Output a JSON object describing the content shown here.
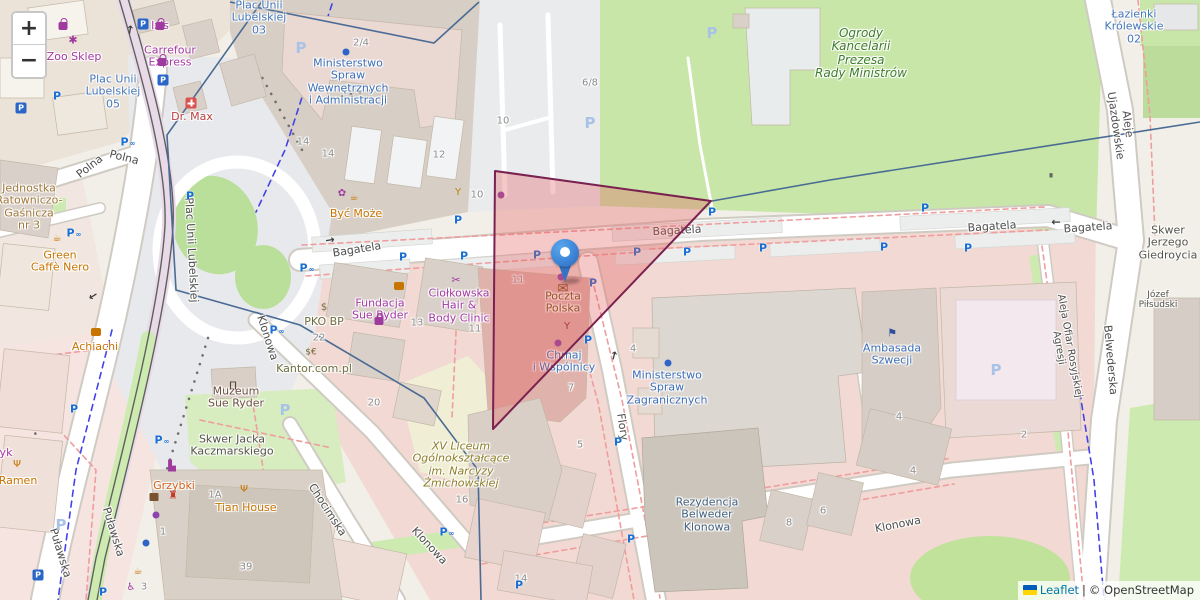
{
  "map_app": {
    "controls": {
      "zoom_in": "+",
      "zoom_out": "−"
    },
    "attribution": {
      "leaflet": "Leaflet",
      "separator": "|",
      "copyright": "© OpenStreetMap"
    },
    "colors": {
      "boundary": "#4a6b94",
      "highlight_fill": "#e35b5b",
      "highlight_stroke": "#7a2150",
      "marker_blue": "#3b82d6",
      "parking_blue": "#1a6fd4",
      "link_blue": "#0078a8"
    },
    "marker": {
      "x": 565,
      "y": 281,
      "poi": "Poczta Polska"
    },
    "highlight_polygon": {
      "points": "495,171 711,201 493,429",
      "fill_opacity": 0.33
    },
    "boundaries": [
      "263,0 167,135 176,290 300,325 424,398 478,470 481,600",
      "230,2 434,43 479,2",
      "712,201 830,180 1200,122"
    ],
    "parking_glyph": "P",
    "bike_glyph": "∞",
    "labels": [
      {
        "t": "Polna",
        "x": 90,
        "y": 167,
        "r": -38,
        "k": "street"
      },
      {
        "t": "Polna",
        "x": 124,
        "y": 158,
        "r": 14,
        "k": "street"
      },
      {
        "t": "Plac Unii Lubelskiej",
        "x": 191,
        "y": 250,
        "r": 87,
        "k": "street"
      },
      {
        "t": "Bagatela",
        "x": 357,
        "y": 250,
        "r": -9,
        "k": "street"
      },
      {
        "t": "Bagatela",
        "x": 677,
        "y": 231,
        "r": -3,
        "k": "street"
      },
      {
        "t": "Bagatela",
        "x": 992,
        "y": 227,
        "r": -4,
        "k": "street"
      },
      {
        "t": "Bagatela",
        "x": 1088,
        "y": 228,
        "r": -4,
        "k": "street"
      },
      {
        "t": "Klonowa",
        "x": 267,
        "y": 338,
        "r": 72,
        "k": "street"
      },
      {
        "t": "Klonowa",
        "x": 429,
        "y": 546,
        "r": 47,
        "k": "street"
      },
      {
        "t": "Klonowa",
        "x": 898,
        "y": 525,
        "r": -11,
        "k": "street"
      },
      {
        "t": "Chocimska",
        "x": 327,
        "y": 510,
        "r": 57,
        "k": "street"
      },
      {
        "t": "Puławska",
        "x": 60,
        "y": 553,
        "r": 73,
        "k": "street"
      },
      {
        "t": "Puławska",
        "x": 113,
        "y": 532,
        "r": 73,
        "k": "street"
      },
      {
        "t": "Flory",
        "x": 622,
        "y": 427,
        "r": 81,
        "k": "street"
      },
      {
        "t": "Aleje Ujazdowskie",
        "x": 1121,
        "y": 125,
        "r": 82,
        "k": "street"
      },
      {
        "t": "Belwederska",
        "x": 1110,
        "y": 360,
        "r": 85,
        "k": "street"
      },
      {
        "t": "Aleja Ofiar Rosyjskiej Agresji",
        "x": 1064,
        "y": 347,
        "r": 80,
        "k": "street",
        "s": 10
      },
      {
        "t": "Plac Unii\nLubelskiej\n05",
        "x": 113,
        "y": 92,
        "k": "place"
      },
      {
        "t": "Plac Unii\nLubelskiej\n03",
        "x": 259,
        "y": 18,
        "k": "place"
      },
      {
        "t": "Łazienki\nKrólewskie\n02",
        "x": 1134,
        "y": 27,
        "k": "place"
      },
      {
        "t": "Ogrody\nKancelarii\nPrezesa\nRady Ministrów",
        "x": 861,
        "y": 54,
        "k": "park",
        "s": 12,
        "n": "park-label"
      },
      {
        "t": "Skwer Jacka\nKaczmarskiego",
        "x": 232,
        "y": 446,
        "k": "gray"
      },
      {
        "t": "Skwer Jerzego\nGiedroycia",
        "x": 1168,
        "y": 243,
        "k": "gray"
      },
      {
        "t": "Józef Piłsudski",
        "x": 1158,
        "y": 300,
        "k": "gray",
        "s": 9
      },
      {
        "t": "Zoo Sklep",
        "x": 74,
        "y": 57,
        "k": "purple"
      },
      {
        "t": "Izis",
        "x": 160,
        "y": 26,
        "k": "purple"
      },
      {
        "t": "Carrefour\nExpress",
        "x": 170,
        "y": 57,
        "k": "purple"
      },
      {
        "t": "Dr. Max",
        "x": 192,
        "y": 117,
        "k": "red"
      },
      {
        "t": "Jednostka\nRatowniczo-\nGaśnicza\nnr 3",
        "x": 29,
        "y": 207,
        "k": "tan"
      },
      {
        "t": "Green\nCaffè Nero",
        "x": 60,
        "y": 262,
        "k": "orange"
      },
      {
        "t": "Achiachi",
        "x": 95,
        "y": 347,
        "k": "orange"
      },
      {
        "t": "yk",
        "x": 6,
        "y": 453,
        "k": "purple"
      },
      {
        "t": "Ramen",
        "x": 18,
        "y": 481,
        "k": "orange"
      },
      {
        "t": "Muzeum\nSue Ryder",
        "x": 236,
        "y": 398,
        "k": "museum"
      },
      {
        "t": "Grzybki",
        "x": 174,
        "y": 486,
        "k": "orange2"
      },
      {
        "t": "Tian House",
        "x": 246,
        "y": 508,
        "k": "orange"
      },
      {
        "t": "Być Może",
        "x": 356,
        "y": 214,
        "k": "orange"
      },
      {
        "t": "Fundacja\nSue Ryder",
        "x": 380,
        "y": 310,
        "k": "purple"
      },
      {
        "t": "PKO BP",
        "x": 324,
        "y": 322,
        "k": "olive"
      },
      {
        "t": "Kantor.com.pl",
        "x": 314,
        "y": 369,
        "k": "olive"
      },
      {
        "t": "Ciołkowska\nHair &\nBody Clinic",
        "x": 459,
        "y": 306,
        "k": "purple"
      },
      {
        "t": "Poczta\nPolska",
        "x": 563,
        "y": 303,
        "k": "brown",
        "n": "marker-poi-label"
      },
      {
        "t": "Chmaj\ni Wspólnicy",
        "x": 564,
        "y": 362,
        "k": "blue"
      },
      {
        "t": "Ministerstwo\nSpraw\nZagranicznych",
        "x": 667,
        "y": 388,
        "k": "blue"
      },
      {
        "t": "Ambasada\nSzwecji",
        "x": 892,
        "y": 355,
        "k": "blue"
      },
      {
        "t": "Rezydencja\nBelweder\nKlonowa",
        "x": 707,
        "y": 515,
        "k": "resid"
      },
      {
        "t": "XV Liceum\nOgólnokształcące\nim. Narcyzy\nŻmichowskiej",
        "x": 461,
        "y": 465,
        "k": "school"
      },
      {
        "t": "Ministerstwo\nSpraw\nWewnętrznych\ni Administracji",
        "x": 348,
        "y": 82,
        "k": "blue"
      },
      {
        "t": "2/4",
        "x": 361,
        "y": 43,
        "k": "num"
      },
      {
        "t": "14",
        "x": 303,
        "y": 142,
        "k": "num"
      },
      {
        "t": "14",
        "x": 328,
        "y": 154,
        "k": "num"
      },
      {
        "t": "12",
        "x": 439,
        "y": 155,
        "k": "num"
      },
      {
        "t": "10",
        "x": 503,
        "y": 121,
        "k": "num"
      },
      {
        "t": "10",
        "x": 477,
        "y": 195,
        "k": "num"
      },
      {
        "t": "6/8",
        "x": 590,
        "y": 83,
        "k": "num"
      },
      {
        "t": "22",
        "x": 319,
        "y": 338,
        "k": "num"
      },
      {
        "t": "13",
        "x": 417,
        "y": 323,
        "k": "num"
      },
      {
        "t": "11",
        "x": 475,
        "y": 329,
        "k": "num"
      },
      {
        "t": "11",
        "x": 518,
        "y": 280,
        "k": "num"
      },
      {
        "t": "7",
        "x": 571,
        "y": 388,
        "k": "num"
      },
      {
        "t": "5",
        "x": 580,
        "y": 445,
        "k": "num"
      },
      {
        "t": "4",
        "x": 633,
        "y": 349,
        "k": "num"
      },
      {
        "t": "16",
        "x": 462,
        "y": 500,
        "k": "num"
      },
      {
        "t": "20",
        "x": 374,
        "y": 403,
        "k": "num"
      },
      {
        "t": "1A",
        "x": 215,
        "y": 495,
        "k": "num"
      },
      {
        "t": "1",
        "x": 163,
        "y": 532,
        "k": "num"
      },
      {
        "t": "39",
        "x": 246,
        "y": 567,
        "k": "num"
      },
      {
        "t": "3",
        "x": 144,
        "y": 587,
        "k": "num"
      },
      {
        "t": "8",
        "x": 789,
        "y": 523,
        "k": "num"
      },
      {
        "t": "6",
        "x": 823,
        "y": 511,
        "k": "num"
      },
      {
        "t": "4",
        "x": 913,
        "y": 471,
        "k": "num"
      },
      {
        "t": "2",
        "x": 1024,
        "y": 435,
        "k": "num"
      },
      {
        "t": "4",
        "x": 899,
        "y": 417,
        "k": "num"
      },
      {
        "t": "14",
        "x": 521,
        "y": 579,
        "k": "num"
      }
    ],
    "parking": [
      {
        "x": 57,
        "y": 96,
        "t": "p"
      },
      {
        "x": 128,
        "y": 142,
        "t": "p",
        "b": 1
      },
      {
        "x": 190,
        "y": 196,
        "t": "p"
      },
      {
        "x": 74,
        "y": 233,
        "t": "p",
        "b": 1
      },
      {
        "x": 307,
        "y": 268,
        "t": "p",
        "b": 1
      },
      {
        "x": 277,
        "y": 330,
        "t": "p",
        "b": 1
      },
      {
        "x": 403,
        "y": 257,
        "t": "p"
      },
      {
        "x": 464,
        "y": 256,
        "t": "p"
      },
      {
        "x": 458,
        "y": 220,
        "t": "p"
      },
      {
        "x": 537,
        "y": 255,
        "t": "p"
      },
      {
        "x": 593,
        "y": 283,
        "t": "p"
      },
      {
        "x": 588,
        "y": 340,
        "t": "p"
      },
      {
        "x": 618,
        "y": 442,
        "t": "p"
      },
      {
        "x": 631,
        "y": 539,
        "t": "p"
      },
      {
        "x": 519,
        "y": 585,
        "t": "p"
      },
      {
        "x": 447,
        "y": 532,
        "t": "p",
        "b": 1
      },
      {
        "x": 637,
        "y": 252,
        "t": "p"
      },
      {
        "x": 687,
        "y": 252,
        "t": "p"
      },
      {
        "x": 712,
        "y": 212,
        "t": "p"
      },
      {
        "x": 763,
        "y": 248,
        "t": "p"
      },
      {
        "x": 884,
        "y": 247,
        "t": "p"
      },
      {
        "x": 925,
        "y": 208,
        "t": "p"
      },
      {
        "x": 968,
        "y": 248,
        "t": "p"
      },
      {
        "x": 74,
        "y": 409,
        "t": "p"
      },
      {
        "x": 162,
        "y": 440,
        "t": "p",
        "b": 1
      },
      {
        "x": 103,
        "y": 592,
        "t": "p"
      },
      {
        "x": 143,
        "y": 24,
        "t": "sq"
      },
      {
        "x": 163,
        "y": 80,
        "t": "sq"
      },
      {
        "x": 21,
        "y": 108,
        "t": "sq"
      },
      {
        "x": 38,
        "y": 575,
        "t": "sq"
      },
      {
        "x": 301,
        "y": 48,
        "t": "pale"
      },
      {
        "x": 590,
        "y": 123,
        "t": "pale"
      },
      {
        "x": 712,
        "y": 33,
        "t": "pale"
      },
      {
        "x": 996,
        "y": 370,
        "t": "pale"
      },
      {
        "x": 61,
        "y": 525,
        "t": "pale"
      },
      {
        "x": 285,
        "y": 410,
        "t": "pale"
      }
    ],
    "icons": [
      {
        "sh": "cross",
        "x": 191,
        "y": 103,
        "c": "#d9534f",
        "n": "pharmacy-icon"
      },
      {
        "g": "✱",
        "x": 73,
        "y": 40,
        "c": "#9f3a9f",
        "s": 11,
        "n": "paw-icon"
      },
      {
        "sh": "bag",
        "x": 63,
        "y": 15,
        "c": "#9f3a9f",
        "n": "shop-bag-icon"
      },
      {
        "sh": "bag",
        "x": 160,
        "y": 7,
        "c": "#9f3a9f",
        "n": "shop-bag-icon"
      },
      {
        "sh": "bag",
        "x": 162,
        "y": 35,
        "c": "#9f3a9f",
        "n": "shop-bag-icon"
      },
      {
        "sh": "bag",
        "x": 379,
        "y": 286,
        "c": "#9f3a9f",
        "n": "shop-bag-icon"
      },
      {
        "sh": "burger",
        "x": 399,
        "y": 286,
        "c": "#c77400",
        "n": "fast-food-icon"
      },
      {
        "sh": "burger",
        "x": 96,
        "y": 332,
        "c": "#c77400",
        "n": "fast-food-icon"
      },
      {
        "g": "✿",
        "x": 342,
        "y": 194,
        "c": "#9f3a9f",
        "s": 10,
        "n": "florist-icon"
      },
      {
        "g": "☕",
        "x": 354,
        "y": 198,
        "c": "#c77400",
        "s": 10,
        "n": "cafe-icon"
      },
      {
        "g": "☕",
        "x": 57,
        "y": 239,
        "c": "#c77400",
        "s": 10,
        "n": "cafe-icon"
      },
      {
        "g": "☕",
        "x": 138,
        "y": 572,
        "c": "#c77400",
        "s": 10,
        "n": "cafe-icon"
      },
      {
        "g": "Ψ",
        "x": 17,
        "y": 465,
        "c": "#c77400",
        "s": 10,
        "n": "restaurant-icon"
      },
      {
        "g": "Ψ",
        "x": 244,
        "y": 490,
        "c": "#c77400",
        "s": 10,
        "n": "restaurant-icon"
      },
      {
        "g": "Y",
        "x": 458,
        "y": 193,
        "c": "#b8860b",
        "s": 10,
        "n": "bar-icon"
      },
      {
        "g": "Y",
        "x": 567,
        "y": 327,
        "c": "#8a2b4a",
        "s": 10,
        "n": "bar-icon"
      },
      {
        "g": "✂",
        "x": 456,
        "y": 280,
        "c": "#9f3a9f",
        "s": 11,
        "n": "hairdresser-icon"
      },
      {
        "g": "✉",
        "x": 563,
        "y": 289,
        "c": "#734a08",
        "s": 13,
        "n": "post-office-icon"
      },
      {
        "g": "⚑",
        "x": 892,
        "y": 333,
        "c": "#2d4f9e",
        "s": 11,
        "n": "embassy-flag-icon"
      },
      {
        "g": "Π",
        "x": 233,
        "y": 386,
        "c": "#5a4436",
        "s": 11,
        "n": "museum-icon"
      },
      {
        "g": "$",
        "x": 324,
        "y": 308,
        "c": "#6e6e3e",
        "s": 10,
        "n": "bank-icon"
      },
      {
        "g": "$€",
        "x": 311,
        "y": 353,
        "c": "#6e6e3e",
        "s": 9,
        "n": "currency-exchange-icon"
      },
      {
        "g": "♿",
        "x": 131,
        "y": 588,
        "c": "#9f3a9f",
        "s": 10,
        "n": "accessible-icon"
      },
      {
        "g": "♜",
        "x": 173,
        "y": 495,
        "c": "#c0392b",
        "s": 11,
        "n": "castle-icon"
      },
      {
        "g": "▙",
        "x": 172,
        "y": 467,
        "c": "#9f3a9f",
        "s": 10,
        "n": "works-icon"
      },
      {
        "sh": "kiosk",
        "x": 154,
        "y": 497,
        "c": "#7a5230",
        "n": "kiosk-icon"
      },
      {
        "g": "∎",
        "x": 1051,
        "y": 176,
        "c": "#666666",
        "s": 9,
        "n": "monument-icon"
      },
      {
        "sh": "dot",
        "x": 501,
        "y": 195,
        "c": "#8e44ad",
        "n": "poi-dot"
      },
      {
        "sh": "dot",
        "x": 561,
        "y": 277,
        "c": "#8e44ad",
        "n": "poi-dot"
      },
      {
        "sh": "dot",
        "x": 558,
        "y": 343,
        "c": "#8e44ad",
        "n": "poi-dot"
      },
      {
        "sh": "dot",
        "x": 156,
        "y": 515,
        "c": "#8e44ad",
        "n": "poi-dot"
      },
      {
        "sh": "dot",
        "x": 346,
        "y": 52,
        "c": "#2e64c8",
        "n": "poi-dot"
      },
      {
        "sh": "dot",
        "x": 668,
        "y": 363,
        "c": "#2e64c8",
        "n": "poi-dot"
      },
      {
        "sh": "dot",
        "x": 146,
        "y": 543,
        "c": "#2e64c8",
        "n": "poi-dot"
      }
    ],
    "arrows": [
      {
        "g": "↑",
        "x": 130,
        "y": 30,
        "r": 8
      },
      {
        "g": "←",
        "x": 1056,
        "y": 222,
        "r": 0
      },
      {
        "g": "→",
        "x": 330,
        "y": 240,
        "r": -9
      },
      {
        "g": "←",
        "x": 93,
        "y": 296,
        "r": -32
      },
      {
        "g": "↑",
        "x": 614,
        "y": 356,
        "r": 14
      }
    ]
  }
}
